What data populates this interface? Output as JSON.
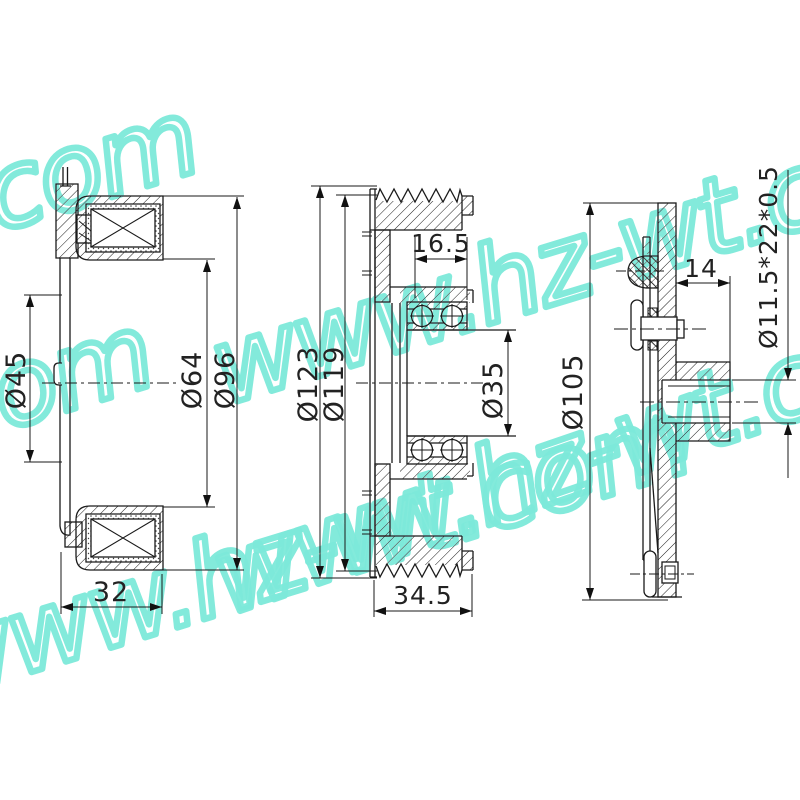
{
  "canvas": {
    "background": "#ffffff",
    "line_color": "#1a1a1a",
    "watermark_color": "#7de9da"
  },
  "watermark": {
    "text": "www.hz-wt.com",
    "fragment": "com"
  },
  "views": {
    "left": {
      "dims": {
        "d45": "Ø45",
        "d64": "Ø64",
        "d96": "Ø96",
        "w32": "32"
      }
    },
    "middle": {
      "dims": {
        "d123": "Ø123",
        "d119": "Ø119",
        "bearing_w": "16.5",
        "d35": "Ø35",
        "w345": "34.5"
      }
    },
    "right": {
      "dims": {
        "d105": "Ø105",
        "w14": "14",
        "spec": "Ø11.5*22*0.5"
      }
    }
  }
}
